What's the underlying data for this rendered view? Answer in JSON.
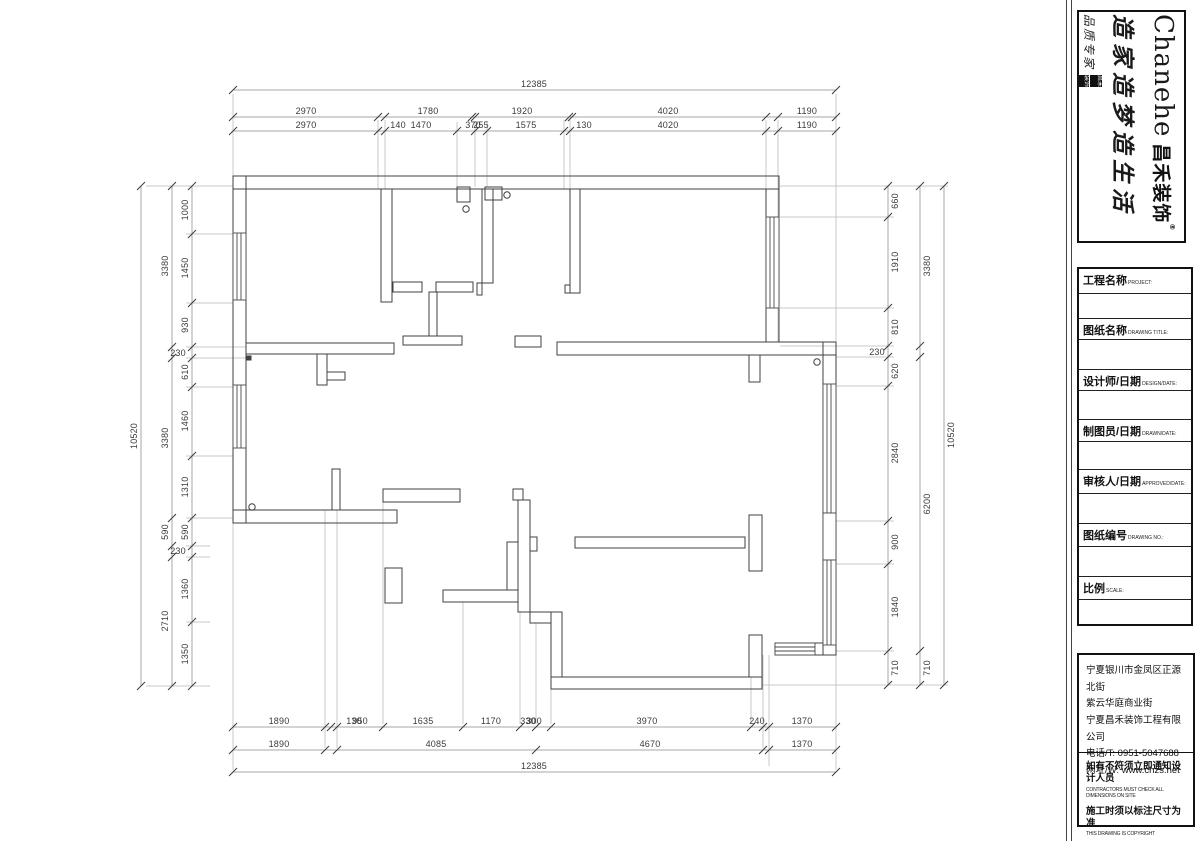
{
  "brand": {
    "english": "Chanehe",
    "chinese": "昌禾装饰",
    "reg": "®",
    "slogan": "造家造梦造生活",
    "side_text": "品质专家",
    "seal1": "昌禾",
    "seal2": "装饰"
  },
  "titleblock": {
    "rows": [
      {
        "zh": "工程名称",
        "en": "PROJECT:"
      },
      {
        "zh": "图纸名称",
        "en": "DRAWING TITLE:"
      },
      {
        "zh": "设计师/日期",
        "en": "DESIGN/DATE:"
      },
      {
        "zh": "制图员/日期",
        "en": "DRAWN/DATE:"
      },
      {
        "zh": "审核人/日期",
        "en": "APPROVED/DATE:"
      },
      {
        "zh": "图纸编号",
        "en": "DRAWING NO.:"
      },
      {
        "zh": "比例",
        "en": "SCALE:"
      }
    ]
  },
  "company": {
    "address1": "宁夏银川市金凤区正源北街",
    "address2": "紫云华庭商业街",
    "name": "宁夏昌禾装饰工程有限公司",
    "phone": "电话/T: 0951-5047688",
    "web": "网址/W: www.chzs.net",
    "notice1_zh": "如有不符须立即通知设计人员",
    "notice1_en": "CONTRACTORS MUST CHECK ALL DIMENSIONS ON SITE",
    "notice2_zh": "施工时须以标注尺寸为准",
    "notice2_en": "THIS DRAWING IS COPYRIGHT"
  },
  "dim_labels": [
    {
      "t": "12385",
      "x": 534,
      "y": 84
    },
    {
      "t": "2970",
      "x": 306,
      "y": 111
    },
    {
      "t": "1780",
      "x": 428,
      "y": 111
    },
    {
      "t": "1920",
      "x": 522,
      "y": 111
    },
    {
      "t": "4020",
      "x": 668,
      "y": 111
    },
    {
      "t": "1190",
      "x": 807,
      "y": 111
    },
    {
      "t": "2970",
      "x": 306,
      "y": 125
    },
    {
      "t": "140",
      "x": 398,
      "y": 125
    },
    {
      "t": "1470",
      "x": 421,
      "y": 125
    },
    {
      "t": "370",
      "x": 473,
      "y": 125
    },
    {
      "t": "255",
      "x": 481,
      "y": 125
    },
    {
      "t": "1575",
      "x": 526,
      "y": 125
    },
    {
      "t": "130",
      "x": 584,
      "y": 125
    },
    {
      "t": "4020",
      "x": 668,
      "y": 125
    },
    {
      "t": "1190",
      "x": 807,
      "y": 125
    },
    {
      "t": "1890",
      "x": 279,
      "y": 721
    },
    {
      "t": "130",
      "x": 354,
      "y": 721
    },
    {
      "t": "950",
      "x": 360,
      "y": 721
    },
    {
      "t": "1635",
      "x": 423,
      "y": 721
    },
    {
      "t": "1170",
      "x": 491,
      "y": 721
    },
    {
      "t": "330",
      "x": 528,
      "y": 721
    },
    {
      "t": "300",
      "x": 534,
      "y": 721
    },
    {
      "t": "3970",
      "x": 647,
      "y": 721
    },
    {
      "t": "240",
      "x": 757,
      "y": 721
    },
    {
      "t": "1370",
      "x": 802,
      "y": 721
    },
    {
      "t": "1890",
      "x": 279,
      "y": 744
    },
    {
      "t": "4085",
      "x": 436,
      "y": 744
    },
    {
      "t": "4670",
      "x": 650,
      "y": 744
    },
    {
      "t": "1370",
      "x": 802,
      "y": 744
    },
    {
      "t": "12385",
      "x": 534,
      "y": 766
    },
    {
      "t": "1000",
      "x": 185,
      "y": 210,
      "r": 1
    },
    {
      "t": "1450",
      "x": 185,
      "y": 268,
      "r": 1
    },
    {
      "t": "930",
      "x": 185,
      "y": 325,
      "r": 1
    },
    {
      "t": "230",
      "x": 178,
      "y": 353
    },
    {
      "t": "610",
      "x": 185,
      "y": 372,
      "r": 1
    },
    {
      "t": "1460",
      "x": 185,
      "y": 421,
      "r": 1
    },
    {
      "t": "1310",
      "x": 185,
      "y": 487,
      "r": 1
    },
    {
      "t": "590",
      "x": 185,
      "y": 532,
      "r": 1
    },
    {
      "t": "230",
      "x": 178,
      "y": 551
    },
    {
      "t": "1360",
      "x": 185,
      "y": 589,
      "r": 1
    },
    {
      "t": "1350",
      "x": 185,
      "y": 654,
      "r": 1
    },
    {
      "t": "3380",
      "x": 165,
      "y": 266,
      "r": 1
    },
    {
      "t": "3380",
      "x": 165,
      "y": 438,
      "r": 1
    },
    {
      "t": "590",
      "x": 165,
      "y": 532,
      "r": 1
    },
    {
      "t": "2710",
      "x": 165,
      "y": 621,
      "r": 1
    },
    {
      "t": "10520",
      "x": 134,
      "y": 436,
      "r": 1
    },
    {
      "t": "660",
      "x": 895,
      "y": 201,
      "r": 1
    },
    {
      "t": "1910",
      "x": 895,
      "y": 262,
      "r": 1
    },
    {
      "t": "810",
      "x": 895,
      "y": 327,
      "r": 1
    },
    {
      "t": "230",
      "x": 877,
      "y": 352
    },
    {
      "t": "620",
      "x": 895,
      "y": 371,
      "r": 1
    },
    {
      "t": "2840",
      "x": 895,
      "y": 453,
      "r": 1
    },
    {
      "t": "900",
      "x": 895,
      "y": 542,
      "r": 1
    },
    {
      "t": "1840",
      "x": 895,
      "y": 607,
      "r": 1
    },
    {
      "t": "710",
      "x": 895,
      "y": 668,
      "r": 1
    },
    {
      "t": "3380",
      "x": 927,
      "y": 266,
      "r": 1
    },
    {
      "t": "6200",
      "x": 927,
      "y": 504,
      "r": 1
    },
    {
      "t": "710",
      "x": 927,
      "y": 668,
      "r": 1
    },
    {
      "t": "10520",
      "x": 951,
      "y": 435,
      "r": 1
    }
  ]
}
